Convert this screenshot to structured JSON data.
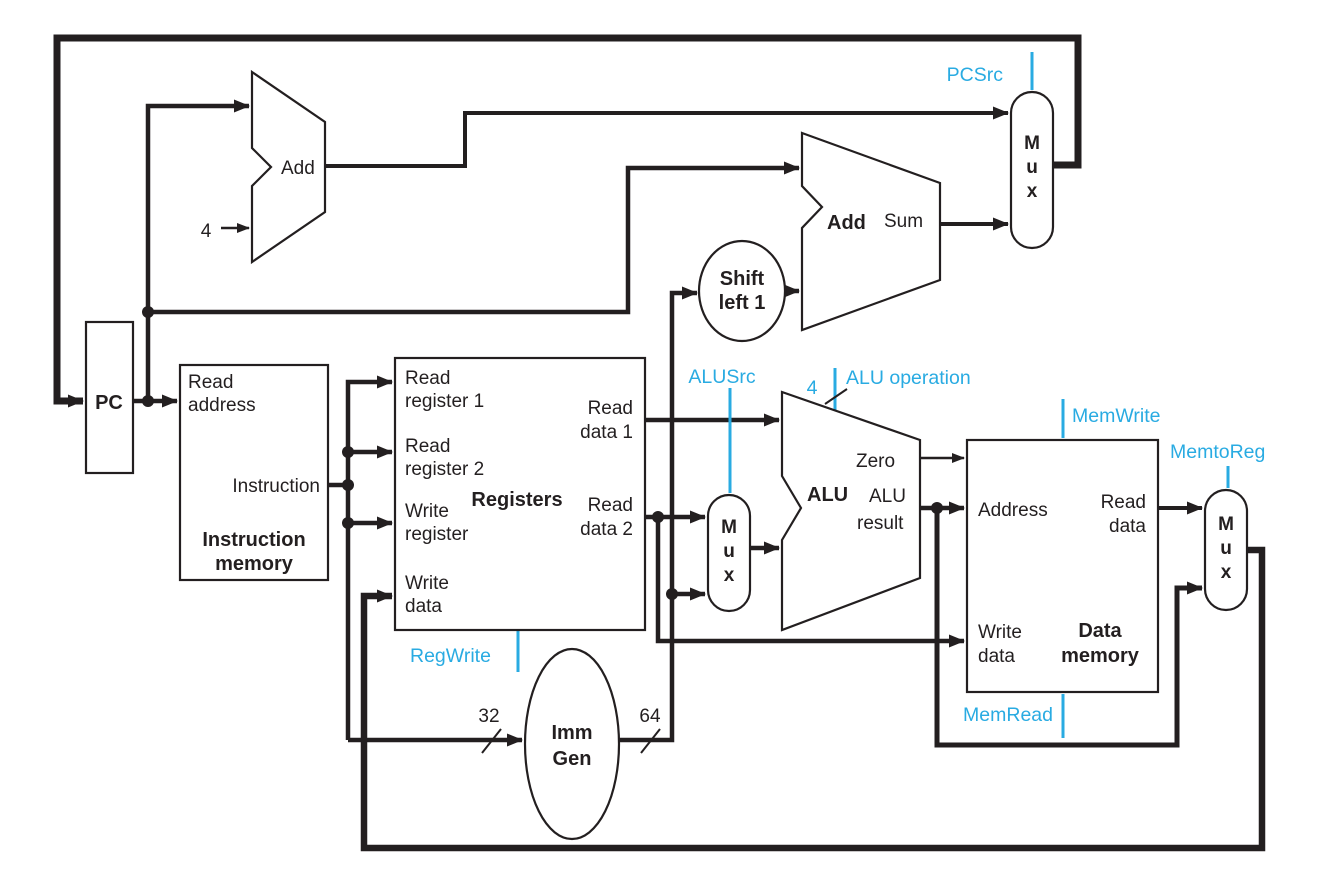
{
  "colors": {
    "control_signal": "#29abe2",
    "wire": "#231f20"
  },
  "pc": {
    "label": "PC"
  },
  "pc_adder": {
    "label": "Add",
    "constant_input": "4"
  },
  "branch_adder": {
    "label": "Add",
    "output_label": "Sum"
  },
  "shift_left": {
    "label_line1": "Shift",
    "label_line2": "left 1"
  },
  "imm_gen": {
    "label_line1": "Imm",
    "label_line2": "Gen",
    "input_bus_width": "32",
    "output_bus_width": "64"
  },
  "instruction_memory": {
    "title_line1": "Instruction",
    "title_line2": "memory",
    "port_read_address_line1": "Read",
    "port_read_address_line2": "address",
    "port_instruction": "Instruction"
  },
  "registers": {
    "title": "Registers",
    "port_read_register_1_line1": "Read",
    "port_read_register_1_line2": "register 1",
    "port_read_register_2_line1": "Read",
    "port_read_register_2_line2": "register 2",
    "port_write_register_line1": "Write",
    "port_write_register_line2": "register",
    "port_write_data_line1": "Write",
    "port_write_data_line2": "data",
    "port_read_data_1_line1": "Read",
    "port_read_data_1_line2": "data 1",
    "port_read_data_2_line1": "Read",
    "port_read_data_2_line2": "data 2"
  },
  "alu": {
    "title": "ALU",
    "port_zero": "Zero",
    "port_result_line1": "ALU",
    "port_result_line2": "result"
  },
  "data_memory": {
    "title_line1": "Data",
    "title_line2": "memory",
    "port_address": "Address",
    "port_read_data_line1": "Read",
    "port_read_data_line2": "data",
    "port_write_data_line1": "Write",
    "port_write_data_line2": "data"
  },
  "mux": {
    "letter_1": "M",
    "letter_2": "u",
    "letter_3": "x"
  },
  "control_signals": {
    "pcsrc": "PCSrc",
    "alusrc": "ALUSrc",
    "alu_operation": "ALU operation",
    "alu_operation_width": "4",
    "regwrite": "RegWrite",
    "memwrite": "MemWrite",
    "memtoreg": "MemtoReg",
    "memread": "MemRead"
  }
}
